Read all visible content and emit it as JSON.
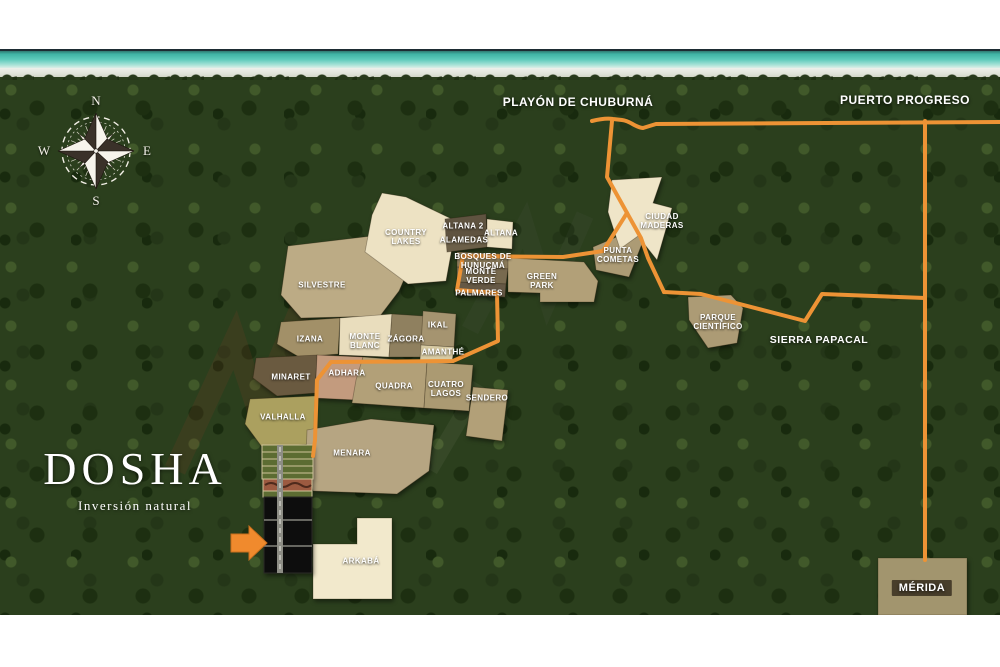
{
  "brand": {
    "name": "DOSHA",
    "tagline": "Inversión natural"
  },
  "compass": {
    "north": "N",
    "east": "E",
    "south": "S",
    "west": "W"
  },
  "places": {
    "playon": "PLAYÓN DE CHUBURNÁ",
    "puerto_progreso": "PUERTO PROGRESO",
    "sierra_papacal": "SIERRA PAPACAL",
    "merida": "MÉRIDA"
  },
  "parcels": [
    {
      "id": "country-lakes",
      "lines": [
        "COUNTRY",
        "LAKES"
      ]
    },
    {
      "id": "altana-2",
      "lines": [
        "ALTANA 2"
      ]
    },
    {
      "id": "alamedas",
      "lines": [
        "ALAMEDAS"
      ]
    },
    {
      "id": "altana",
      "lines": [
        "ALTANA"
      ]
    },
    {
      "id": "bosques-hunucma",
      "lines": [
        "BOSQUES DE",
        "HUNUCMÁ"
      ]
    },
    {
      "id": "monte-verde",
      "lines": [
        "MONTE",
        "VERDE"
      ]
    },
    {
      "id": "palmares",
      "lines": [
        "PALMARES"
      ]
    },
    {
      "id": "green-park",
      "lines": [
        "GREEN",
        "PARK"
      ]
    },
    {
      "id": "punta-cometas",
      "lines": [
        "PUNTA",
        "COMETAS"
      ]
    },
    {
      "id": "ciudad-maderas",
      "lines": [
        "CIUDAD",
        "MADERAS"
      ]
    },
    {
      "id": "parque-cientifico",
      "lines": [
        "PARQUE",
        "CIENTÍFICO"
      ]
    },
    {
      "id": "silvestre",
      "lines": [
        "SILVESTRE"
      ]
    },
    {
      "id": "izana",
      "lines": [
        "IZANA"
      ]
    },
    {
      "id": "monte-blanc",
      "lines": [
        "MONTE",
        "BLANC"
      ]
    },
    {
      "id": "zagora",
      "lines": [
        "ZÁGORA"
      ]
    },
    {
      "id": "ikal",
      "lines": [
        "IKAL"
      ]
    },
    {
      "id": "amanthe",
      "lines": [
        "AMANTHÉ"
      ]
    },
    {
      "id": "minaret",
      "lines": [
        "MINARET"
      ]
    },
    {
      "id": "adhara",
      "lines": [
        "ADHARA"
      ]
    },
    {
      "id": "quadra",
      "lines": [
        "QUADRA"
      ]
    },
    {
      "id": "cuatro-lagos",
      "lines": [
        "CUATRO",
        "LAGOS"
      ]
    },
    {
      "id": "sendero",
      "lines": [
        "SENDERO"
      ]
    },
    {
      "id": "valhalla",
      "lines": [
        "VALHALLA"
      ]
    },
    {
      "id": "menara",
      "lines": [
        "MENARA"
      ]
    },
    {
      "id": "arkaba",
      "lines": [
        "ARKABÁ"
      ]
    }
  ],
  "colors": {
    "road": "#ED9335",
    "arrow": "#F08A2D",
    "ocean": "#5ECABB",
    "forest": "#2B3F1D",
    "cream_parcel": "#EFE4C6",
    "tan_parcel": "#B2A078",
    "dark_parcel": "#6A5A40",
    "black_parcel": "#0D0D0B"
  }
}
